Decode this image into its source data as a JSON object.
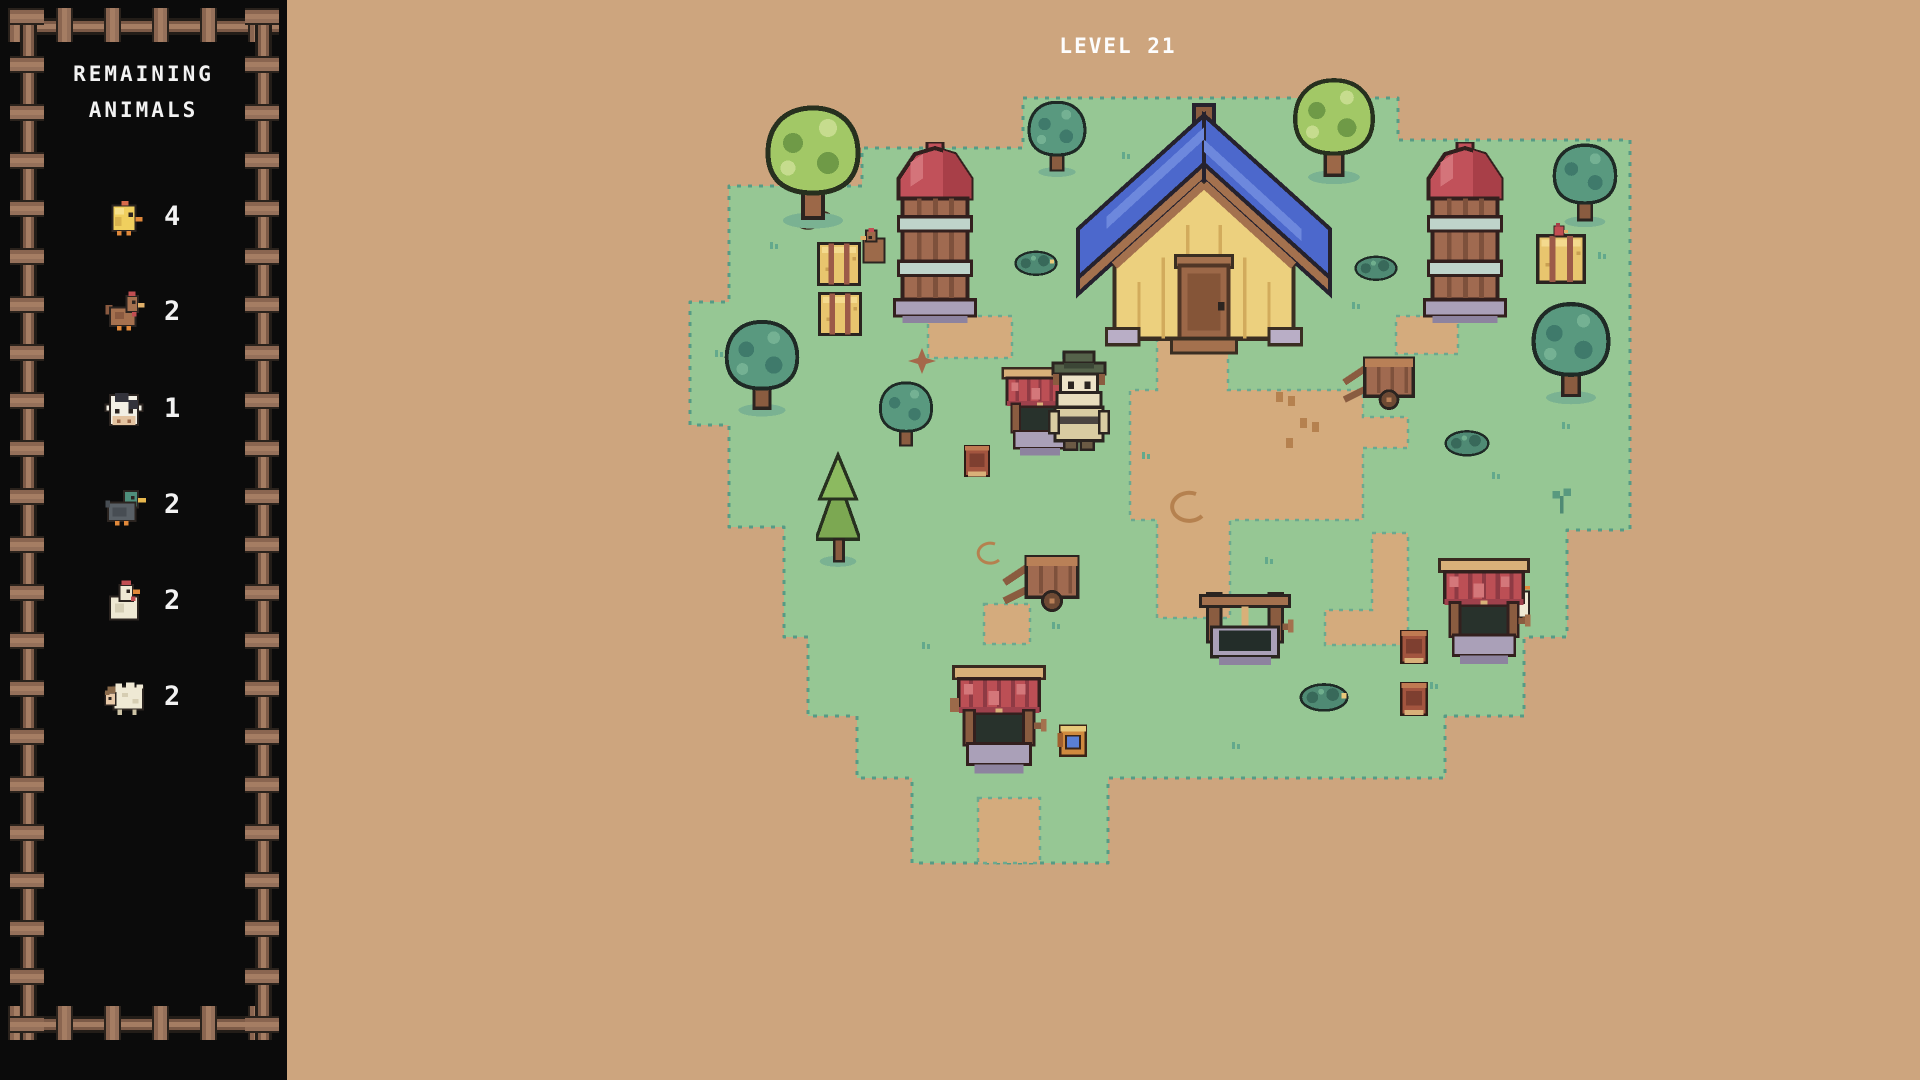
{
  "level_label": "LEVEL 21",
  "sidebar": {
    "title_line1": "REMAINING",
    "title_line2": "ANIMALS",
    "animals": [
      {
        "name": "chick",
        "icon": "chick-icon",
        "count": "4"
      },
      {
        "name": "chicken",
        "icon": "chicken-icon",
        "count": "2"
      },
      {
        "name": "cow",
        "icon": "cow-icon",
        "count": "1"
      },
      {
        "name": "duck",
        "icon": "duck-icon",
        "count": "2"
      },
      {
        "name": "hen",
        "icon": "hen-icon",
        "count": "2"
      },
      {
        "name": "sheep",
        "icon": "sheep-icon",
        "count": "2"
      }
    ]
  },
  "scene": {
    "objects": [
      "barn",
      "silo-left",
      "silo-right",
      "well-awning-farmer",
      "farmer",
      "well-open-center",
      "well-red-right",
      "well-red-bottom",
      "cart-right",
      "cart-center",
      "hay-bale-left-1",
      "hay-bale-left-2",
      "hay-bale-right",
      "bird-on-hay",
      "crate-1",
      "crate-2",
      "book-crate",
      "gold-box",
      "bush-right",
      "bush-bottom",
      "bush-left-of-barn",
      "bush-right-of-barn",
      "tree-light-big",
      "tree-teal-small-top",
      "tree-green-topright",
      "tree-teal-topright",
      "tree-teal-right",
      "tree-teal-left",
      "tree-teal-bushy",
      "pine-tree",
      "sprout",
      "white-chicken-peek",
      "brown-chicken-peek",
      "rocks-decal",
      "star-decal",
      "hoof-decal",
      "swirl-decal"
    ]
  },
  "colors": {
    "outside_ground": "#cda57e",
    "grass": "#96c794",
    "grass_edge": "#569b85",
    "dirt_path": "#d4ab7d",
    "sidebar_bg": "#0b0b0b",
    "frame_wood": "#a57d63",
    "text": "#f2f2f2",
    "barn_roof": "#4c68cc",
    "barn_wall": "#ecd07e",
    "silo_dome": "#c1515a",
    "well_roof": "#bc4f55"
  }
}
